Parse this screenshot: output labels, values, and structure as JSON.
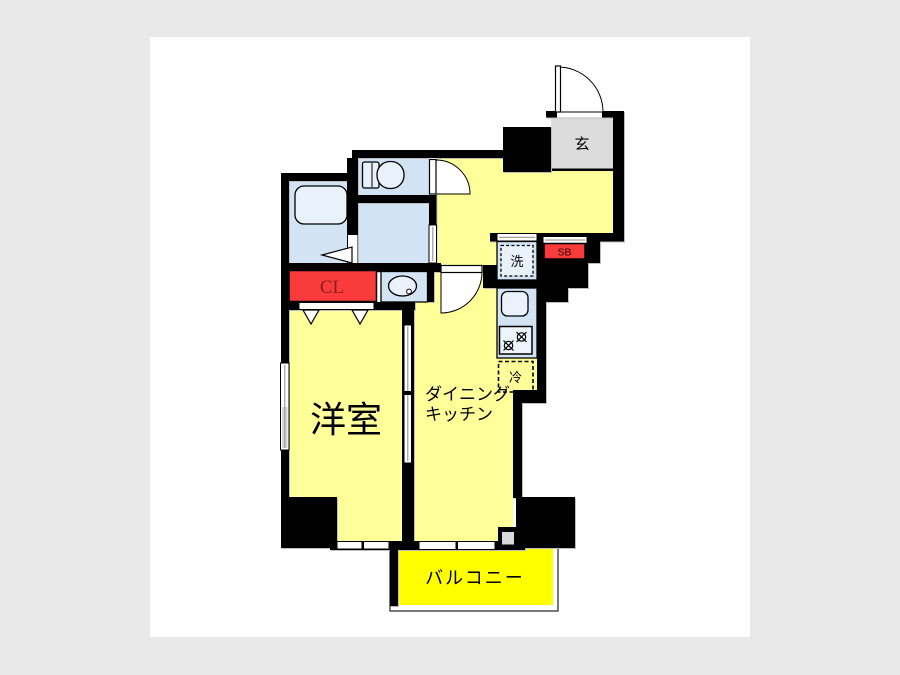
{
  "plan": {
    "title": "apartment-floor-plan",
    "labels": {
      "genkan": "玄",
      "laundry": "洗",
      "shoe_box": "SB",
      "refrigerator": "冷",
      "closet": "CL",
      "western_room": "洋室",
      "dk_line1": "ダイニング",
      "dk_line2": "キッチン",
      "balcony": "バルコニー"
    },
    "colors": {
      "page_bg": "#e9e9e9",
      "canvas": "#ffffff",
      "wall": "#000000",
      "room_yellow": "#ffff99",
      "balcony_yellow": "#ffff00",
      "water_blue": "#d2e3f4",
      "fixture_blue": "#e9f1fb",
      "entry_gray": "#dcdcdc",
      "accent_red": "#f93b3b",
      "cl_text": "#8b1d1d",
      "gray_pane": "#d8d8d8"
    }
  }
}
